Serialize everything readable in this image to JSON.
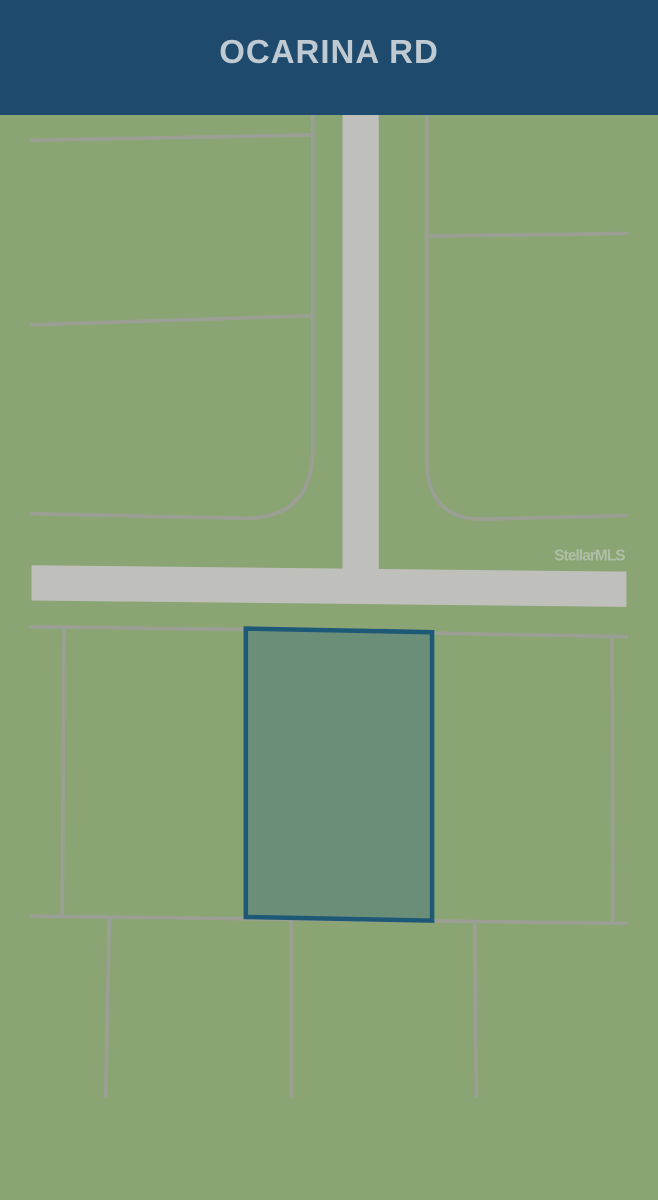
{
  "header": {
    "title": "OCARINA RD"
  },
  "map": {
    "watermark": "StellarMLS",
    "colors": {
      "land": "#8AA473",
      "road": "#BFC0BB",
      "parcel_line": "#9B9F95",
      "highlight_fill": "#6B8E78",
      "highlight_border": "#1D5977",
      "banner_bg": "#1D4A6D",
      "banner_text": "#C0CAD2",
      "watermark_text": "#C6CFC6"
    }
  }
}
